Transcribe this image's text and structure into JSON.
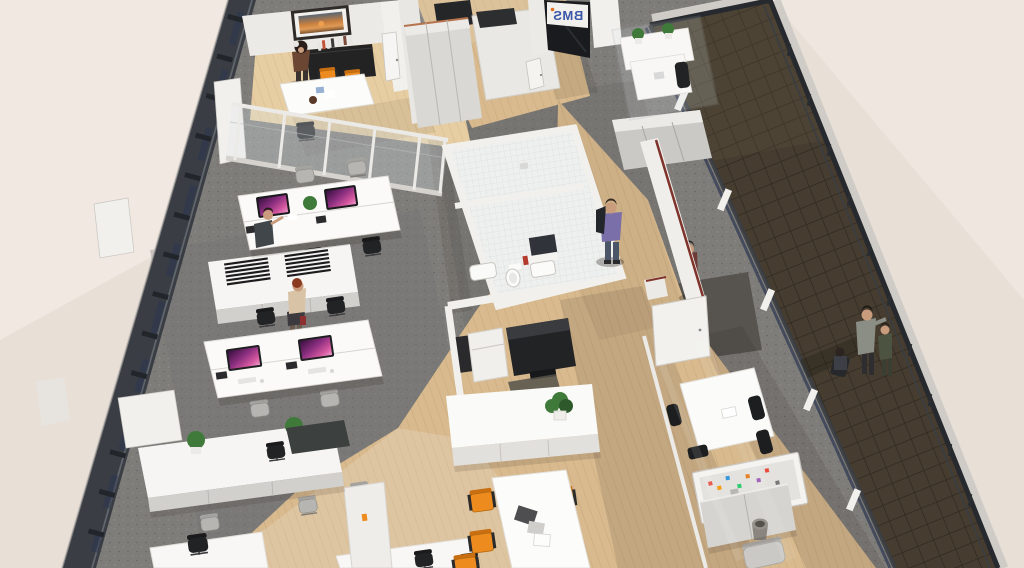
{
  "meta": {
    "description": "3D isometric bird's-eye architectural rendering of an open-plan office floor",
    "view": "aerial cutaway, no visible UI chrome"
  },
  "sign": {
    "text": "BMS",
    "mirrored": true,
    "text_color": "#3a57a8",
    "dot_color": "#e0701f",
    "bg": "#f4f3f1"
  },
  "palette": {
    "bg": "#e8dfd7",
    "bg_light": "#f5efe8",
    "carpet": "#7f7d7a",
    "carpet_dark": "#66645f",
    "wood": "#d8ba8e",
    "wood_light": "#e6cda2",
    "wall": "#f2f0ed",
    "wall_mid": "#dcd9d4",
    "wall_dark": "#c0bdb8",
    "facade": "#3a3e44",
    "facade_light": "#6a7077",
    "glass_blue": "#2c3650",
    "glass_tint": "#dfe7ea",
    "terrace": "#463d30",
    "terrace_grout": "#2c251d",
    "railing": "#26292d",
    "parapet": "#cfccc7",
    "orange": "#ee8b1f",
    "orange_dark": "#c96f12",
    "screen_purple": "#8c2f80",
    "plant": "#3f7a3a",
    "plant_dark": "#2e5a2b",
    "furniture_black": "#222325",
    "furniture_gray": "#b7b5b1",
    "cabinet_gray": "#cbc9c6",
    "copper": "#b5744d",
    "red_trim": "#7e332b",
    "skin": "#c99c7d",
    "sign_blue": "#3a57a8",
    "sign_orange": "#e0701f"
  },
  "zones": [
    {
      "id": "meeting-room-top-left",
      "floor": "wood",
      "features": [
        "sunset artwork",
        "black credenza with books",
        "white meeting table",
        "2 orange chairs",
        "standing woman",
        "glass partition",
        "white door"
      ]
    },
    {
      "id": "entrance",
      "floor": "wood",
      "features": [
        "dark glass storefront",
        "mirrored BMS sign",
        "tall cabinets with copper trim",
        "white storage room"
      ]
    },
    {
      "id": "open-office",
      "floor": "carpet",
      "features": [
        "2 bench-desk clusters",
        "4 iMac monitors with purple screens",
        "desk phones",
        "black and gray task chairs",
        "2 white sideboards",
        "black paper-tray stacks",
        "plants",
        "seated worker",
        "standing woman"
      ]
    },
    {
      "id": "restroom-block",
      "floor": "tile",
      "features": [
        "white tiled walls",
        "toilet",
        "urinal",
        "sink",
        "dark mirror",
        "red bin"
      ]
    },
    {
      "id": "print-corner",
      "floor": "wood",
      "features": [
        "large black copier",
        "small white printer",
        "dark floor mat"
      ]
    },
    {
      "id": "central-hub",
      "floor": "wood",
      "features": [
        "white sideboard with plant",
        "white dining table",
        "6 orange chairs",
        "papers on table"
      ]
    },
    {
      "id": "right-meeting-room",
      "floor": "wood",
      "features": [
        "white conference table",
        "black chairs",
        "pinboard with colorful notes",
        "low cabinets",
        "waste bin",
        "lounge chair",
        "glass walls",
        "white wall with red trim",
        "open white door"
      ]
    },
    {
      "id": "terrace",
      "floor": "dark brown tiles",
      "features": [
        "railing",
        "two people at railing",
        "seated person"
      ]
    }
  ],
  "people": [
    {
      "id": "woman-meeting-room",
      "desc": "dark curly hair, brown top, standing at credenza"
    },
    {
      "id": "worker-seated-desk",
      "desc": "dark shirt, seated at upper desk cluster"
    },
    {
      "id": "woman-standing-office",
      "desc": "red-brown hair, beige top, dark skirt, red bag"
    },
    {
      "id": "man-walking-corridor",
      "desc": "purple shirt, jeans, jacket over shoulder"
    },
    {
      "id": "man-maroon-corridor",
      "desc": "maroon shirt near right corridor"
    },
    {
      "id": "man-terrace-railing",
      "desc": "gray shirt leaning on railing"
    },
    {
      "id": "person-terrace-railing-2",
      "desc": "dark green top at railing"
    },
    {
      "id": "person-terrace-seated",
      "desc": "seated dark figure on terrace"
    }
  ],
  "counts": {
    "imac_monitors": 4,
    "orange_dining_chairs": 6,
    "orange_meeting_chairs": 2,
    "plants": 7,
    "people": 8
  }
}
